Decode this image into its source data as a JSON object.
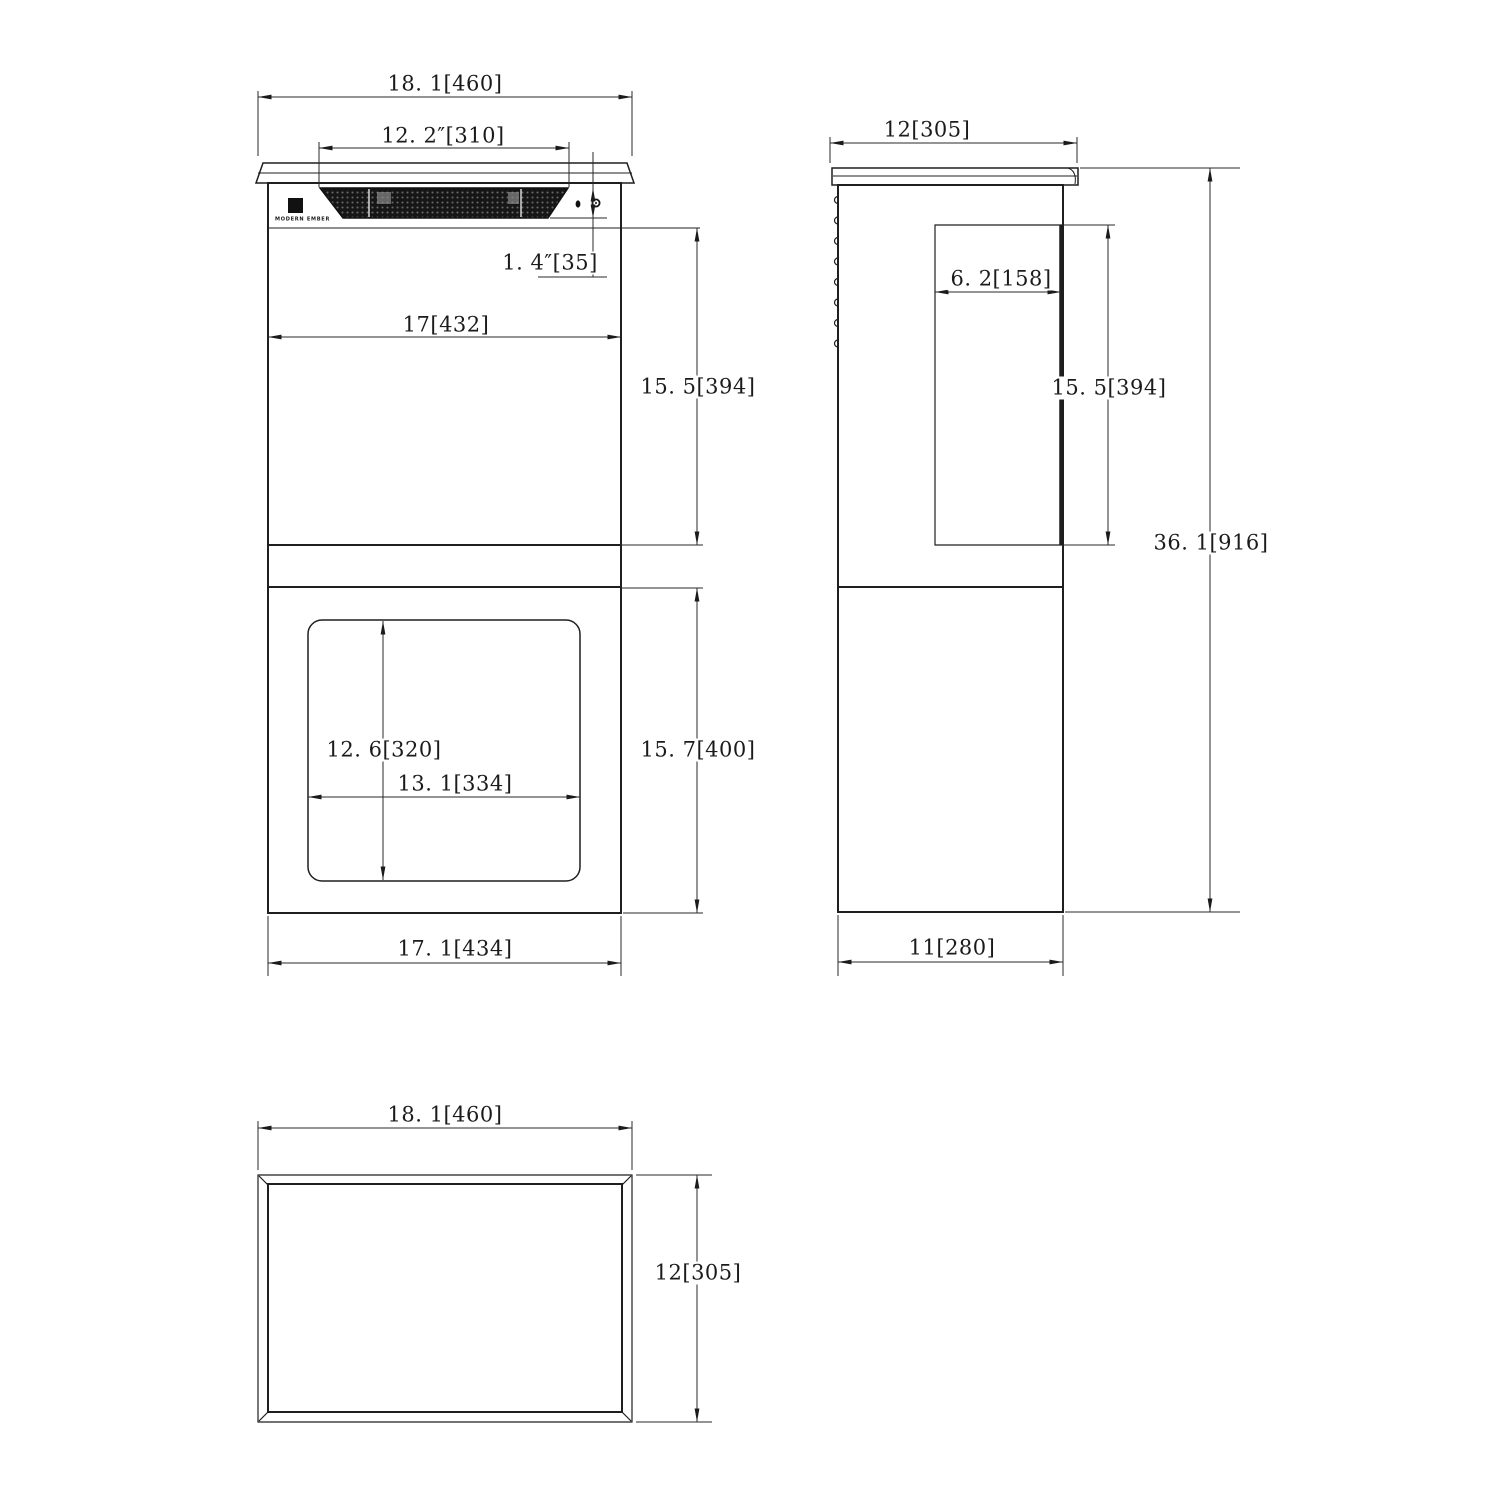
{
  "front_view": {
    "overall_width": "18. 1[460]",
    "grille_width": "12. 2″[310]",
    "grille_height": "1. 4″[35]",
    "body_width": "17[432]",
    "upper_height": "15. 5[394]",
    "window_height": "12. 6[320]",
    "window_width": "13. 1[334]",
    "lower_height": "15. 7[400]",
    "base_width": "17. 1[434]",
    "logo": "MODERN EMBER"
  },
  "side_view": {
    "top_depth": "12[305]",
    "vent_depth": "6. 2[158]",
    "vent_height": "15. 5[394]",
    "overall_height": "36. 1[916]",
    "base_depth": "11[280]"
  },
  "bottom_view": {
    "width": "18. 1[460]",
    "depth": "12[305]"
  },
  "colors": {
    "line": "#1f1f1f",
    "dim_line": "#2a2a2a",
    "grille_dark": "#161616",
    "paper": "#ffffff"
  }
}
